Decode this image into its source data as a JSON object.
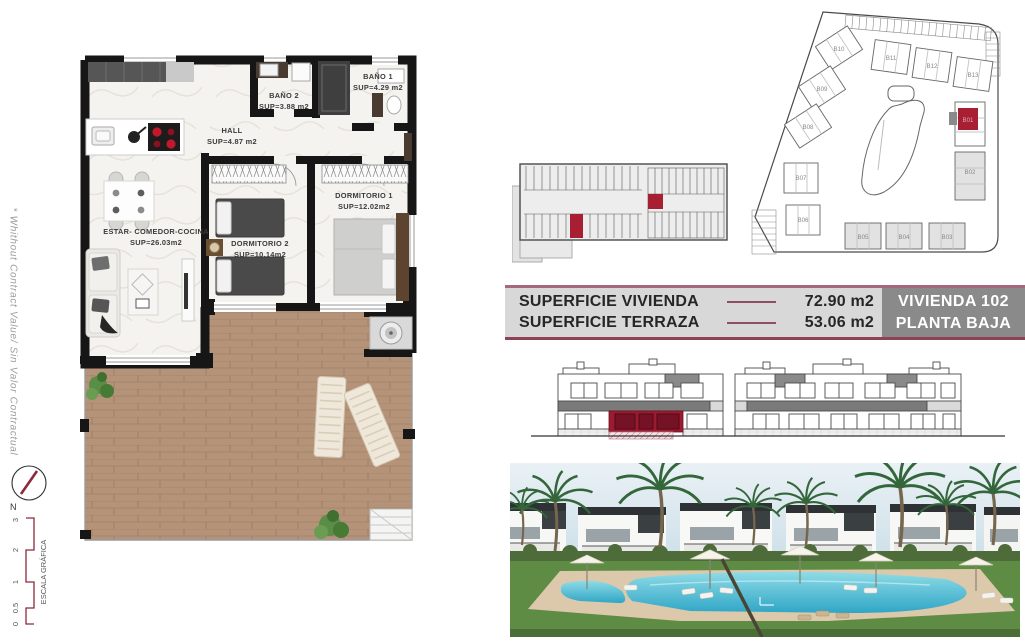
{
  "disclaimer": "* Whithout Contract Value/ Sin Valor Contractual",
  "compass": {
    "label": "N"
  },
  "scale_bar": {
    "title": "ESCALA GRÁFICA",
    "marks": [
      "3",
      "2",
      "1",
      "0.5",
      "0"
    ]
  },
  "floorplan": {
    "rooms": [
      {
        "name": "ESTAR-  COMEDOR-COCINA",
        "area": "SUP=26.03m2"
      },
      {
        "name": "HALL",
        "area": "SUP=4.87 m2"
      },
      {
        "name": "BAÑO 2",
        "area": "SUP=3.88 m2"
      },
      {
        "name": "BAÑO 1",
        "area": "SUP=4.29 m2"
      },
      {
        "name": "DORMITORIO 2",
        "area": "SUP=10.14m2"
      },
      {
        "name": "DORMITORIO 1",
        "area": "SUP=12.02m2"
      }
    ]
  },
  "site_plan": {
    "blocks": [
      {
        "label": "B01"
      },
      {
        "label": "B02"
      },
      {
        "label": "B03"
      },
      {
        "label": "B04"
      },
      {
        "label": "B05"
      },
      {
        "label": "B06"
      },
      {
        "label": "B07"
      },
      {
        "label": "B08"
      },
      {
        "label": "B09"
      },
      {
        "label": "B10"
      },
      {
        "label": "B11"
      },
      {
        "label": "B12"
      },
      {
        "label": "B13"
      }
    ]
  },
  "info_bar": {
    "rows": [
      {
        "label": "SUPERFICIE VIVIENDA",
        "value": "72.90 m2"
      },
      {
        "label": "SUPERFICIE TERRAZA",
        "value": "53.06 m2"
      }
    ],
    "unit_name": "VIVIENDA 102",
    "unit_floor": "PLANTA BAJA"
  },
  "colors": {
    "accent_maroon": "#a01d30",
    "bar_background": "#d8d8d8",
    "unit_box_gray": "#8a8a8a",
    "wall_black": "#161616",
    "deck_wood": "#b49378",
    "pool_blue": "#4fc0d5",
    "grass_green": "#5f8c45"
  }
}
